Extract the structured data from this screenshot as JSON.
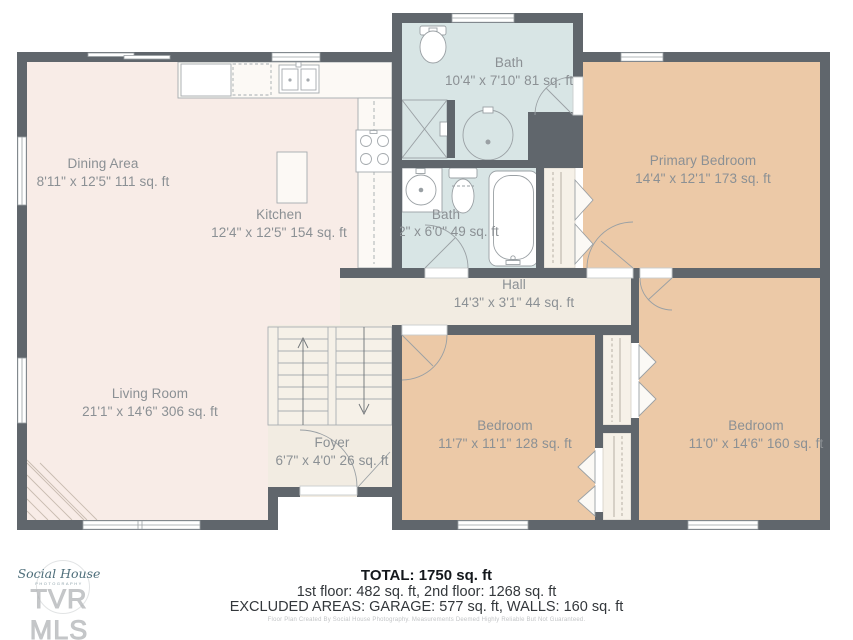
{
  "plan": {
    "rooms": [
      {
        "id": "dining-area",
        "name": "Dining Area",
        "dims": "8'11\" x 12'5\" 111 sq. ft"
      },
      {
        "id": "kitchen",
        "name": "Kitchen",
        "dims": "12'4\" x 12'5\" 154 sq. ft"
      },
      {
        "id": "bath-upper",
        "name": "Bath",
        "dims": "10'4\" x 7'10\" 81 sq. ft"
      },
      {
        "id": "primary-bedroom",
        "name": "Primary Bedroom",
        "dims": "14'4\" x 12'1\" 173 sq. ft"
      },
      {
        "id": "bath-main",
        "name": "Bath",
        "dims": "8'2\" x 6'0\" 49 sq. ft"
      },
      {
        "id": "hall",
        "name": "Hall",
        "dims": "14'3\" x 3'1\" 44 sq. ft"
      },
      {
        "id": "living-room",
        "name": "Living Room",
        "dims": "21'1\" x 14'6\" 306 sq. ft"
      },
      {
        "id": "foyer",
        "name": "Foyer",
        "dims": "6'7\" x 4'0\" 26 sq. ft"
      },
      {
        "id": "bedroom-left",
        "name": "Bedroom",
        "dims": "11'7\" x 11'1\" 128 sq. ft"
      },
      {
        "id": "bedroom-right",
        "name": "Bedroom",
        "dims": "11'0\" x 14'6\" 160 sq. ft"
      }
    ]
  },
  "summary": {
    "total": "TOTAL: 1750 sq. ft",
    "floors": "1st floor: 482 sq. ft, 2nd floor: 1268 sq. ft",
    "excluded": "EXCLUDED AREAS: GARAGE: 577 sq. ft, WALLS: 160 sq. ft",
    "disclaimer": "Floor Plan Created By Social House Photography. Measurements Deemed Highly Reliable But Not Guaranteed."
  },
  "watermark": {
    "logo_script": "Social House",
    "logo_sub": "PHOTOGRAPHY",
    "mls_text": "TVR MLS"
  },
  "colors": {
    "wall": "#60666c",
    "floor_main": "#f8ece7",
    "floor_bath": "#d8e5e5",
    "floor_bedroom": "#ecc9a7",
    "floor_hall": "#f2ece2",
    "floor_closet": "#f6f1e8",
    "fixture_stroke": "#9aa0a4",
    "label_text": "#8b9094"
  }
}
